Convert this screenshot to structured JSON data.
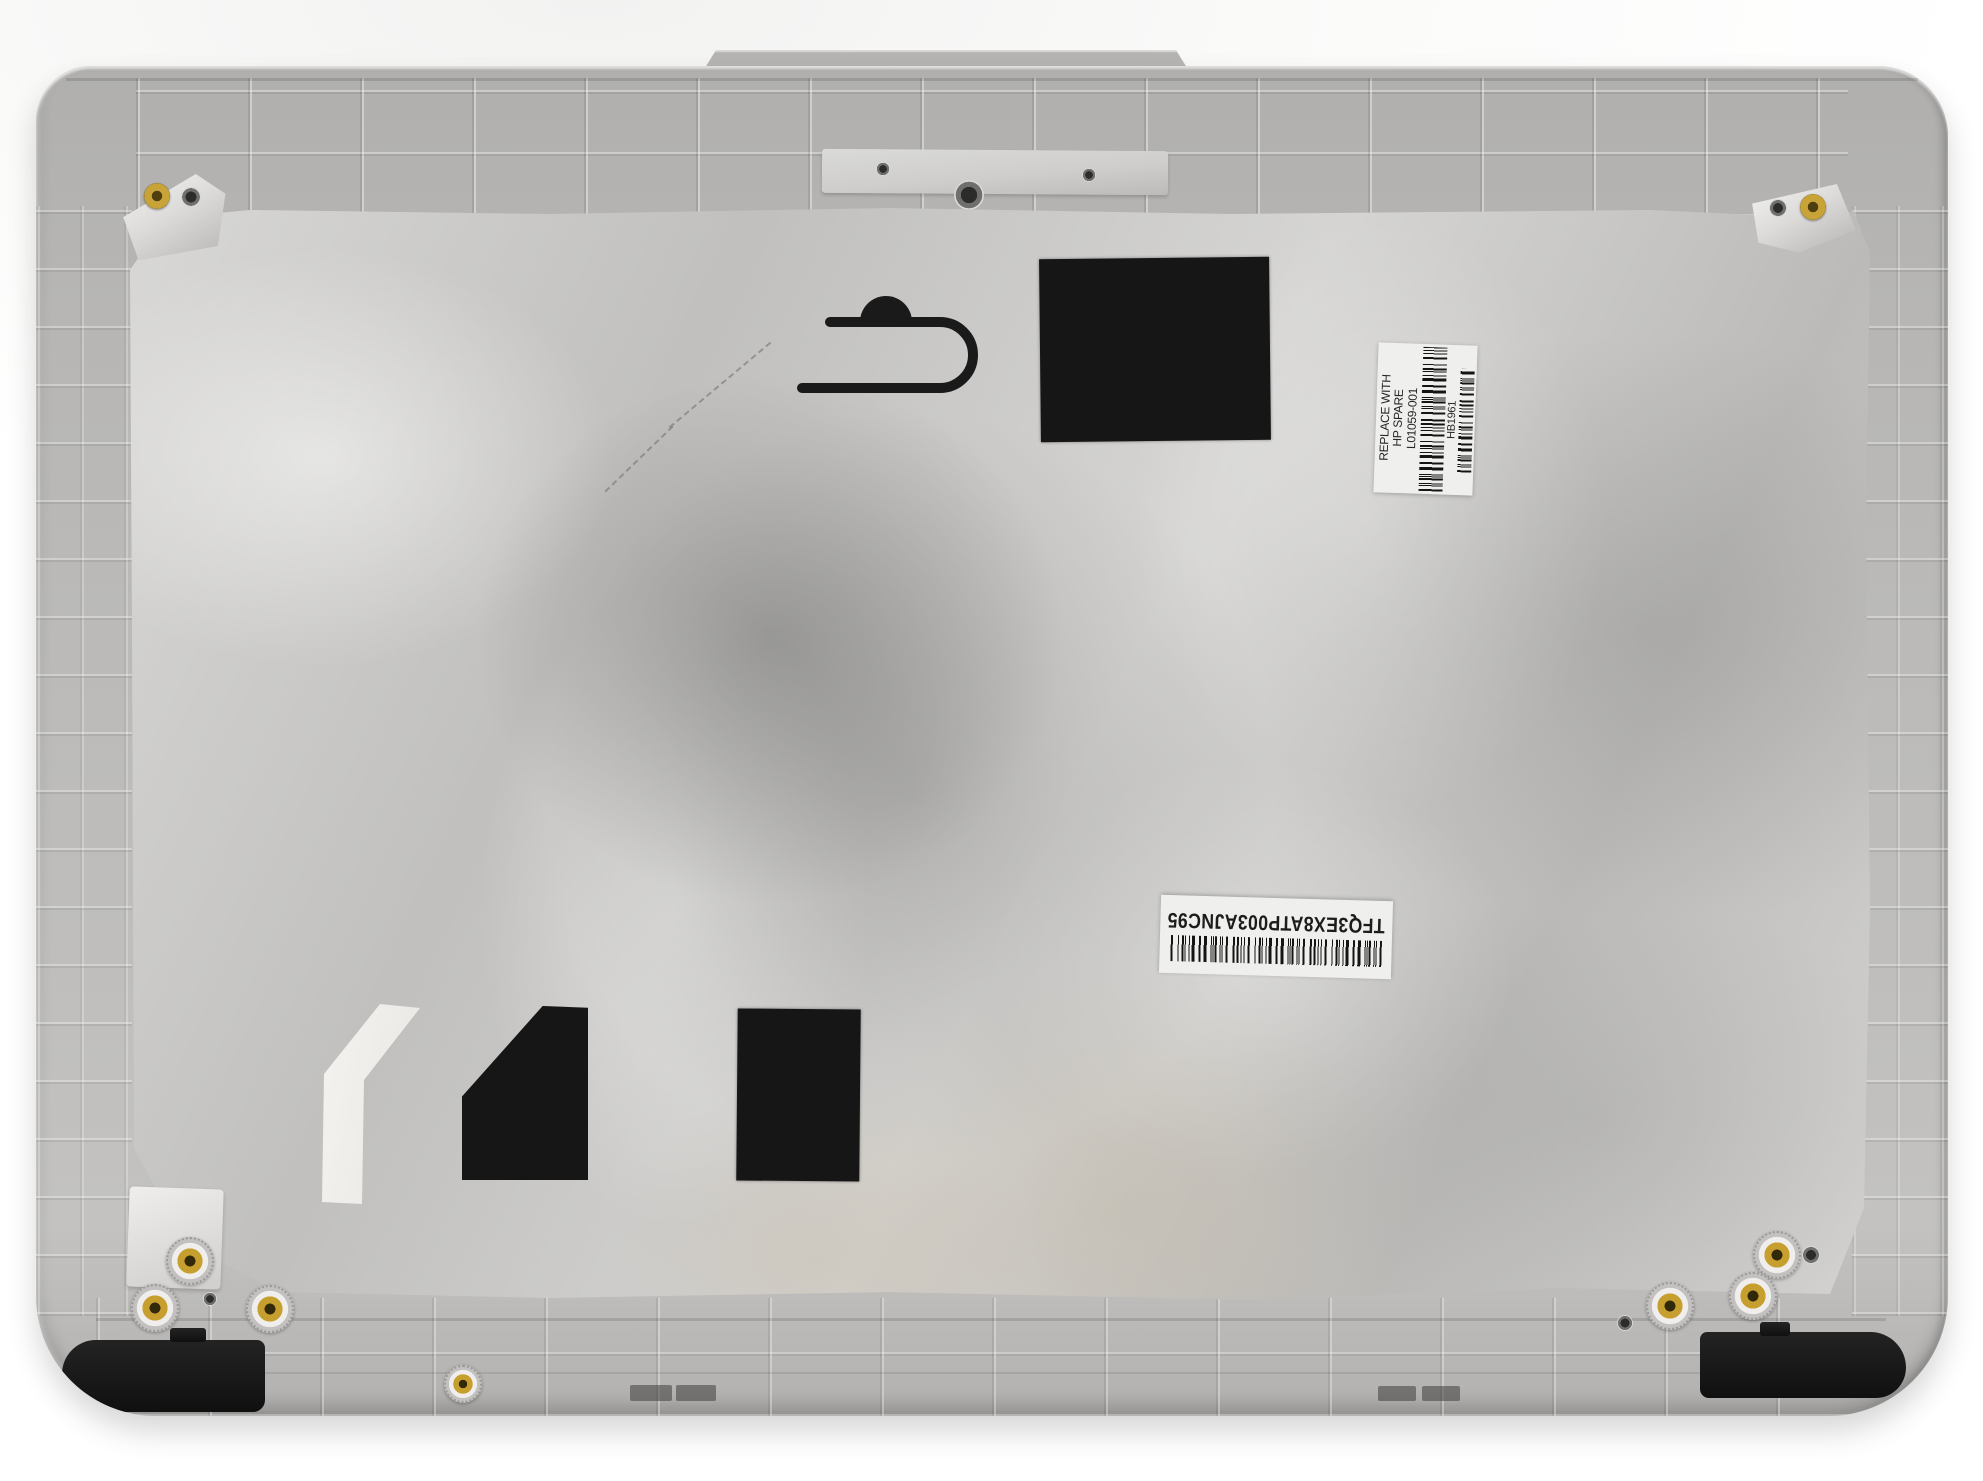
{
  "photo_subject": "laptop-lcd-back-cover-inner-side",
  "labels": {
    "hp_spare_label": {
      "line1": "REPLACE WITH",
      "line2": "HP SPARE",
      "part_number": "L01059-001",
      "code": "HB1961"
    },
    "serial_label": {
      "code": "TFQ3EX8ATP003AJNC95"
    }
  },
  "colors": {
    "cover_plastic": "#b7b6b4",
    "foil": "#cbcac8",
    "pad_black": "#161616",
    "screw_gold": "#c8a338",
    "label_white": "#efefed",
    "background": "#fafafa"
  }
}
